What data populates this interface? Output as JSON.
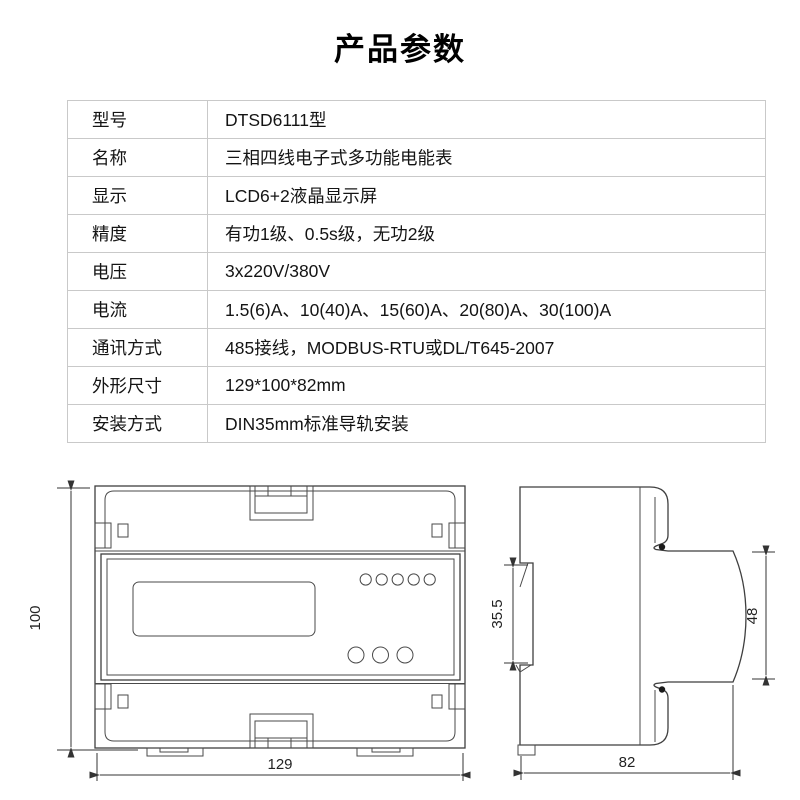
{
  "page": {
    "title": "产品参数"
  },
  "spec_table": {
    "rows": [
      {
        "label": "型号",
        "value": "DTSD6111型"
      },
      {
        "label": "名称",
        "value": "三相四线电子式多功能电能表"
      },
      {
        "label": "显示",
        "value": "LCD6+2液晶显示屏"
      },
      {
        "label": "精度",
        "value": "有功1级、0.5s级，无功2级"
      },
      {
        "label": "电压",
        "value": "3x220V/380V"
      },
      {
        "label": "电流",
        "value": "1.5(6)A、10(40)A、15(60)A、20(80)A、30(100)A"
      },
      {
        "label": "通讯方式",
        "value": "485接线，MODBUS-RTU或DL/T645-2007"
      },
      {
        "label": "外形尺寸",
        "value": "129*100*82mm"
      },
      {
        "label": "安装方式",
        "value": "DIN35mm标准导轨安装"
      }
    ]
  },
  "drawings": {
    "front_view": {
      "height": "100",
      "width": "129"
    },
    "side_view": {
      "rail_slot": "35.5",
      "face_height": "48",
      "depth": "82"
    }
  },
  "colors": {
    "table_border": "#c9c9c9",
    "drawing_line": "#3f3f3f",
    "text": "#141414"
  }
}
